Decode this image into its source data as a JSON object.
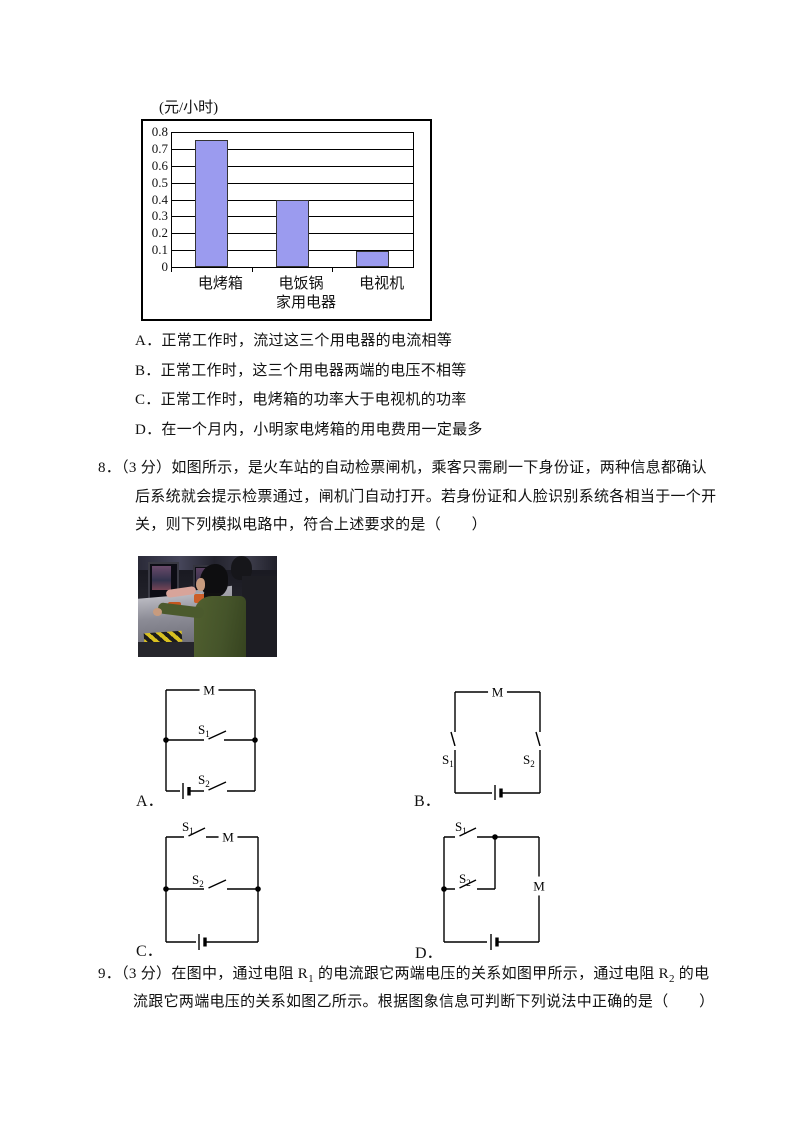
{
  "chart_data": {
    "type": "bar",
    "title": "(元/小时)",
    "categories": [
      "电烤箱",
      "电饭锅",
      "电视机"
    ],
    "values": [
      0.75,
      0.4,
      0.095
    ],
    "xlabel": "家用电器",
    "ylabel": "",
    "ylim": [
      0,
      0.8
    ],
    "yticks": [
      "0",
      "0.1",
      "0.2",
      "0.3",
      "0.4",
      "0.5",
      "0.6",
      "0.7",
      "0.8"
    ],
    "grid": true,
    "legend": false,
    "bar_color": "#9b9bef",
    "bar_border": "#333333"
  },
  "q7_options": [
    "A．正常工作时，流过这三个用电器的电流相等",
    "B．正常工作时，这三个用电器两端的电压不相等",
    "C．正常工作时，电烤箱的功率大于电视机的功率",
    "D．在一个月内，小明家电烤箱的用电费用一定最多"
  ],
  "q8": {
    "lines": [
      "8．（3 分）如图所示，是火车站的自动检票闸机，乘客只需刷一下身份证，两种信息都确认",
      "后系统就会提示检票通过，闸机门自动打开。若身份证和人脸识别系统各相当于一个开",
      "关，则下列模拟电路中，符合上述要求的是（　　）"
    ]
  },
  "q9": {
    "seg1": "9．（3 分）在图中，通过电阻 R",
    "sub1": "1",
    "seg2": " 的电流跟它两端电压的关系如图甲所示，通过电阻 R",
    "sub2": "2",
    "seg3": " 的电",
    "line2": "流跟它两端电压的关系如图乙所示。根据图象信息可判断下列说法中正确的是（　　）"
  },
  "circuits": {
    "motor_label": "M",
    "switch_letter": "S",
    "switch_sub1": "1",
    "switch_sub2": "2",
    "option_a": "A．",
    "option_b": "B．",
    "option_c": "C．",
    "option_d": "D．"
  }
}
